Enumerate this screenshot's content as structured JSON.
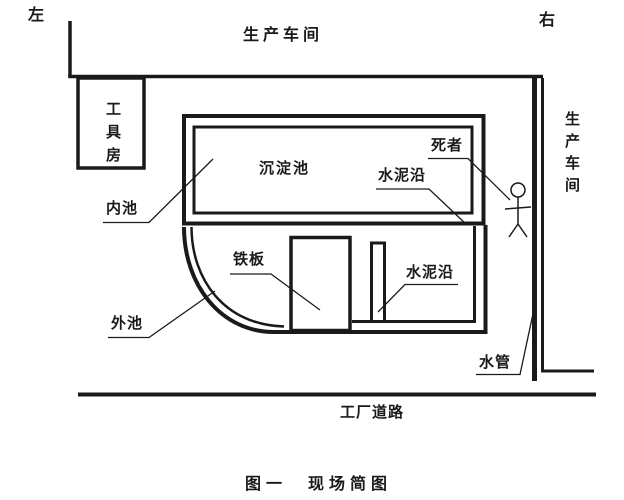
{
  "figure": {
    "orientation_left": "左",
    "orientation_right": "右",
    "caption": "图一　现场简图"
  },
  "areas": {
    "top_workshop": "生产车间",
    "right_workshop": "生产车间",
    "tool_room": "工具房",
    "sedimentation_pool": "沉淀池",
    "factory_road": "工厂道路"
  },
  "callouts": {
    "inner_pool": "内池",
    "outer_pool": "外池",
    "iron_plate": "铁板",
    "cement_edge_top": "水泥沿",
    "cement_edge_bottom": "水泥沿",
    "deceased": "死者",
    "water_pipe": "水管"
  },
  "colors": {
    "line": "#1a1a1a",
    "background": "#ffffff"
  }
}
